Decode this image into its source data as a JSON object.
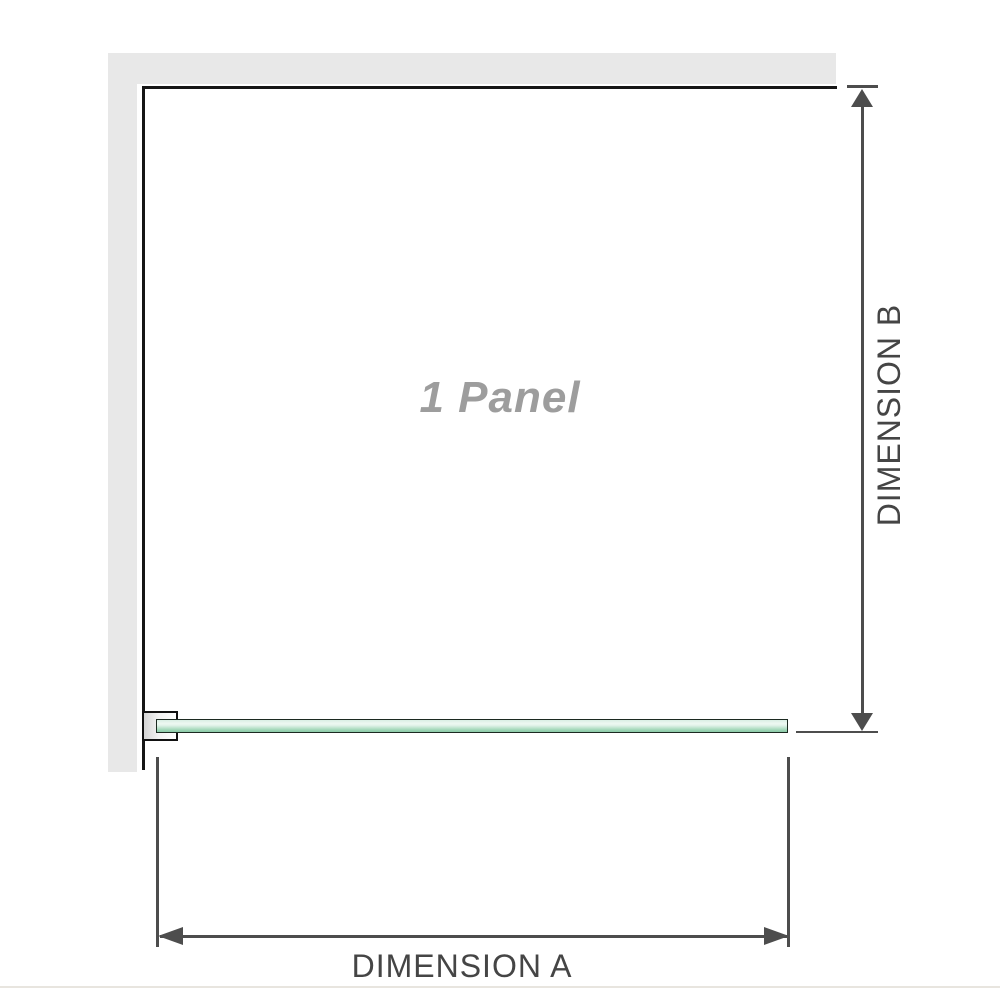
{
  "diagram": {
    "panel_label": "1 Panel",
    "dimension_a_label": "DIMENSION A",
    "dimension_b_label": "DIMENSION B"
  },
  "colors": {
    "background": "#ffffff",
    "wall_fill": "#e8e8e8",
    "enclosure_border": "#161616",
    "dimension_lines": "#4d4d4d",
    "dimension_text": "#454545",
    "panel_label_text": "#9d9d9d",
    "glass_border": "#1c2a21",
    "glass_fill_light": "#eef8f2",
    "glass_fill_dark": "#8ccaa7",
    "bracket_border": "#111111",
    "bottom_edge_line": "#e8e5df"
  },
  "icons": {
    "arrow_up": "dimension-arrowhead-up",
    "arrow_down": "dimension-arrowhead-down",
    "arrow_left": "dimension-arrowhead-left",
    "arrow_right": "dimension-arrowhead-right"
  }
}
